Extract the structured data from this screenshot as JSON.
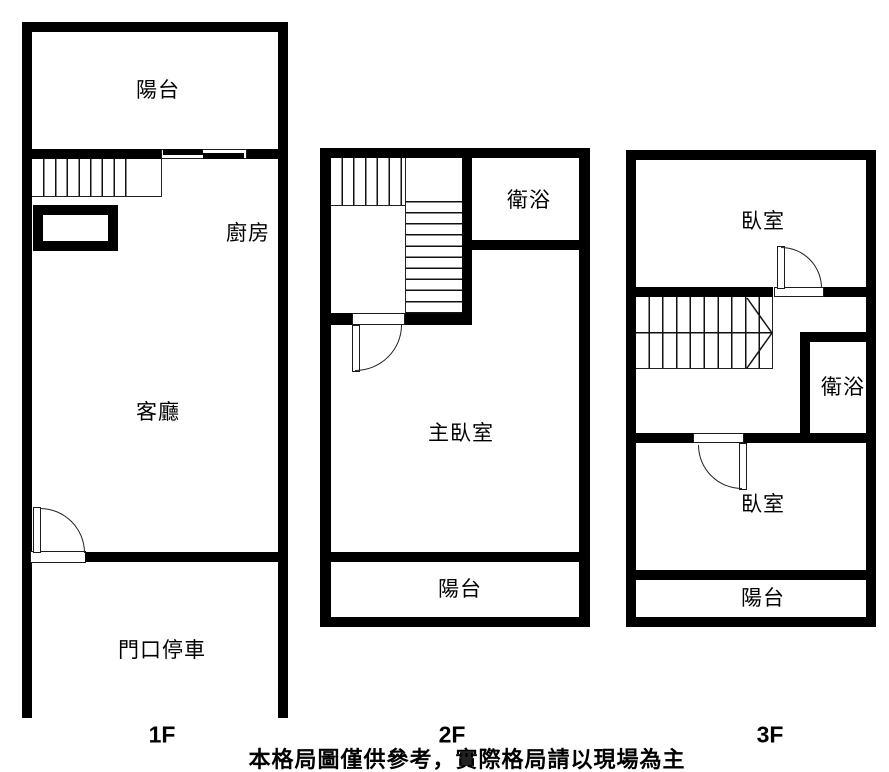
{
  "floors": [
    {
      "label": "1F",
      "rooms": {
        "balcony": "陽台",
        "kitchen": "廚房",
        "living_room": "客廳",
        "parking": "門口停車"
      }
    },
    {
      "label": "2F",
      "rooms": {
        "bathroom": "衛浴",
        "master_bedroom": "主臥室",
        "balcony": "陽台"
      }
    },
    {
      "label": "3F",
      "rooms": {
        "bedroom_top": "臥室",
        "bathroom": "衛浴",
        "bedroom_bottom": "臥室",
        "balcony": "陽台"
      }
    }
  ],
  "disclaimer": "本格局圖僅供參考，實際格局請以現場為主",
  "colors": {
    "wall": "#000000",
    "background": "#ffffff",
    "text": "#000000"
  }
}
